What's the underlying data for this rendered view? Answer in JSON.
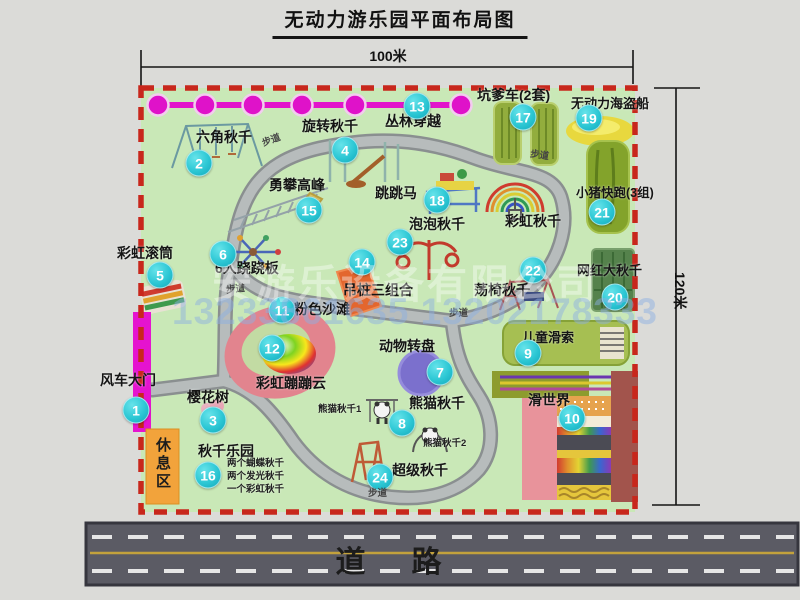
{
  "title": "无动力游乐园平面布局图",
  "dimensions": {
    "width_label": "100米",
    "height_label": "120米"
  },
  "road_label": "道路",
  "path_label": "步道",
  "rest_area_label": "休息区",
  "rainbow_swing_label": "彩虹秋千",
  "watermark": {
    "company": "安游乐设备有限公司",
    "phone": "13233861635 13202178333"
  },
  "attractions": [
    {
      "num": "1",
      "label": "风车大门"
    },
    {
      "num": "2",
      "label": "六角秋千"
    },
    {
      "num": "3",
      "label": "樱花树"
    },
    {
      "num": "4",
      "label": "旋转秋千"
    },
    {
      "num": "5",
      "label": "彩虹滚筒"
    },
    {
      "num": "6",
      "label": "6人跷跷板"
    },
    {
      "num": "7",
      "label": "动物转盘"
    },
    {
      "num": "8",
      "label": "熊猫秋千",
      "notes": [
        "熊猫秋千1",
        "熊猫秋千2"
      ]
    },
    {
      "num": "9",
      "label": "儿童滑索"
    },
    {
      "num": "10",
      "label": "滑世界"
    },
    {
      "num": "11",
      "label": "粉色沙滩"
    },
    {
      "num": "12",
      "label": "彩虹蹦蹦云"
    },
    {
      "num": "13",
      "label": "丛林穿越"
    },
    {
      "num": "14",
      "label": "吊桩三组合"
    },
    {
      "num": "15",
      "label": "勇攀高峰"
    },
    {
      "num": "16",
      "label": "秋千乐园",
      "notes": [
        "两个蝴蝶秋千",
        "两个发光秋千",
        "一个彩虹秋千"
      ]
    },
    {
      "num": "17",
      "label": "坑爹车(2套)"
    },
    {
      "num": "18",
      "label": "跳跳马"
    },
    {
      "num": "19",
      "label": "无动力海盗船"
    },
    {
      "num": "20",
      "label": "网红大秋千"
    },
    {
      "num": "21",
      "label": "小猪快跑(3组)"
    },
    {
      "num": "22",
      "label": "荡椅秋千"
    },
    {
      "num": "23",
      "label": "泡泡秋千"
    },
    {
      "num": "24",
      "label": "超级秋千"
    }
  ]
}
